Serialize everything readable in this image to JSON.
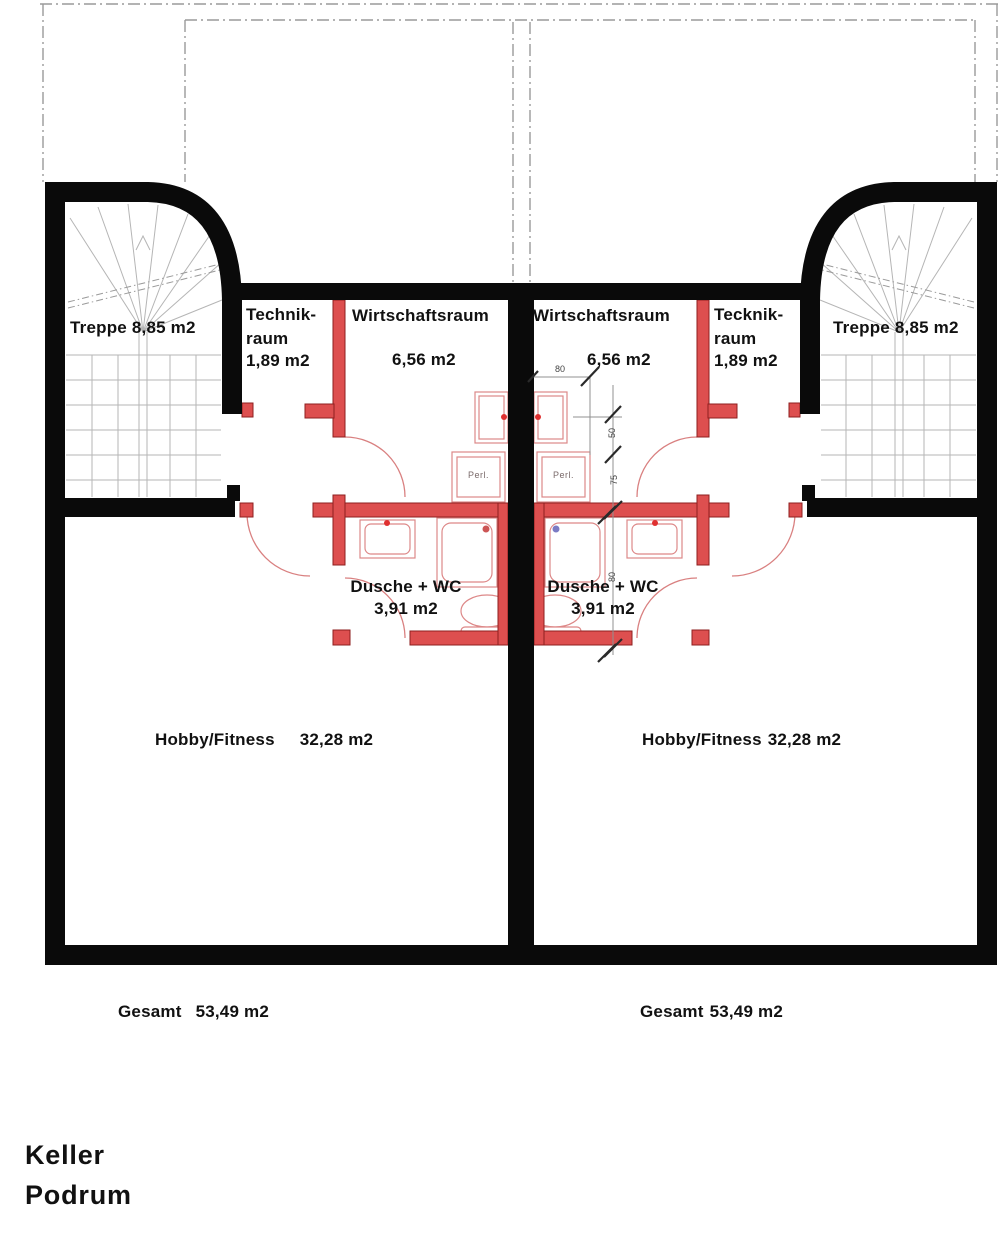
{
  "plan_title": {
    "line1": "Keller",
    "line2": "Podrum"
  },
  "units": {
    "left": {
      "treppe_label": "Treppe 8,85 m2",
      "technik_line1": "Technik-",
      "technik_line2": "raum",
      "technik_area": "1,89 m2",
      "wirtschaft_label": "Wirtschaftsraum",
      "wirtschaft_area": "6,56 m2",
      "dusche_label": "Dusche + WC",
      "dusche_area": "3,91 m2",
      "hobby_label": "Hobby/Fitness",
      "hobby_area": "32,28 m2",
      "gesamt_label": "Gesamt",
      "gesamt_area": "53,49 m2",
      "washer_label": "Perl."
    },
    "right": {
      "treppe_label": "Treppe 8,85 m2",
      "technik_line1": "Tecknik-",
      "technik_line2": "raum",
      "technik_area": "1,89 m2",
      "wirtschaft_label": "Wirtschaftsraum",
      "wirtschaft_area": "6,56 m2",
      "dusche_label": "Dusche + WC",
      "dusche_area": "3,91 m2",
      "hobby_label": "Hobby/Fitness",
      "hobby_area": "32,28 m2",
      "gesamt_label": "Gesamt",
      "gesamt_area": "53,49 m2",
      "washer_label": "Perl."
    }
  },
  "dimensions": {
    "door_width": "80",
    "seg_50": "50",
    "seg_75": "75",
    "seg_80": "80"
  },
  "colors": {
    "structural_wall": "#0a0a0a",
    "partition_red": "#dd4f4f",
    "fixture_pink": "#dd8888",
    "dimension_gray": "#909090",
    "shower_marker_left": "#cc5555",
    "shower_marker_right": "#7b7bc4"
  }
}
